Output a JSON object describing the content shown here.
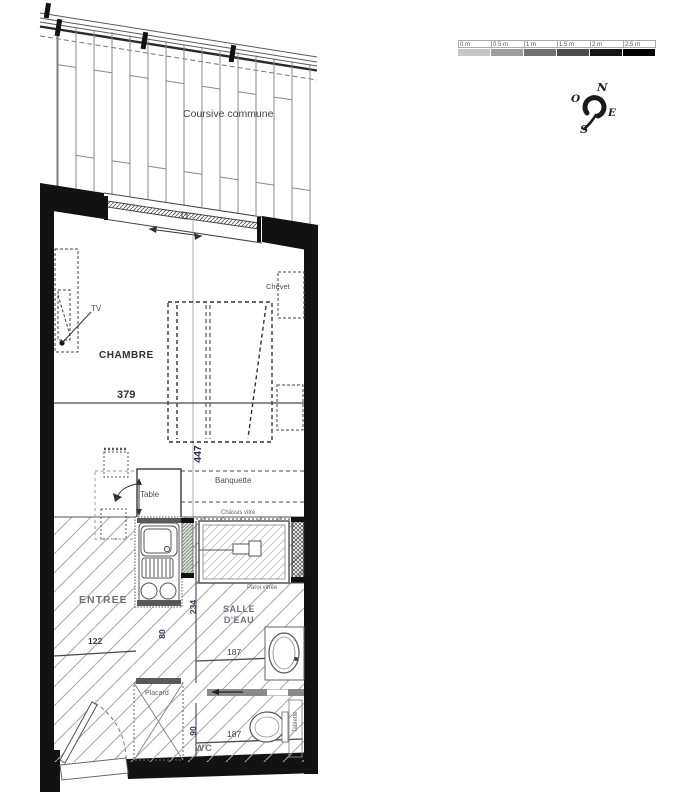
{
  "plan": {
    "coursive_label": "Coursive commune",
    "rooms": {
      "chambre": "CHAMBRE",
      "entree": "ENTREE",
      "salle_deau_l1": "SALLE",
      "salle_deau_l2": "D'EAU",
      "wc": "WC"
    },
    "furniture": {
      "tv": "TV",
      "chevet": "Chevet",
      "table": "Table",
      "banquette": "Banquette",
      "chassis_vitre": "Châssis vitré",
      "paroi_vitree": "Paroi vitrée",
      "placard": "Placard",
      "tablette": "Tablette"
    },
    "dimensions": {
      "chambre_largeur": "379",
      "chambre_profondeur": "447",
      "entree_largeur": "122",
      "salle_deau_largeur": "187",
      "salle_deau_profondeur": "234",
      "degagement": "80",
      "wc_largeur": "187",
      "wc_profondeur": "90"
    }
  },
  "compass": {
    "north": "N",
    "east": "E",
    "south": "S",
    "west": "O"
  },
  "scale_bar": {
    "ticks": [
      "0 m",
      "0.5 m",
      "1 m",
      "1.5 m",
      "2 m",
      "2.5 m"
    ],
    "colors": [
      "#c6c6c6",
      "#9d9d9d",
      "#717171",
      "#4c4c4c",
      "#161616",
      "#000000"
    ]
  },
  "colors": {
    "wall": "#121212",
    "line": "#4a4a4a",
    "hatch": "#a6a6a6",
    "text": "#3c3c46"
  }
}
